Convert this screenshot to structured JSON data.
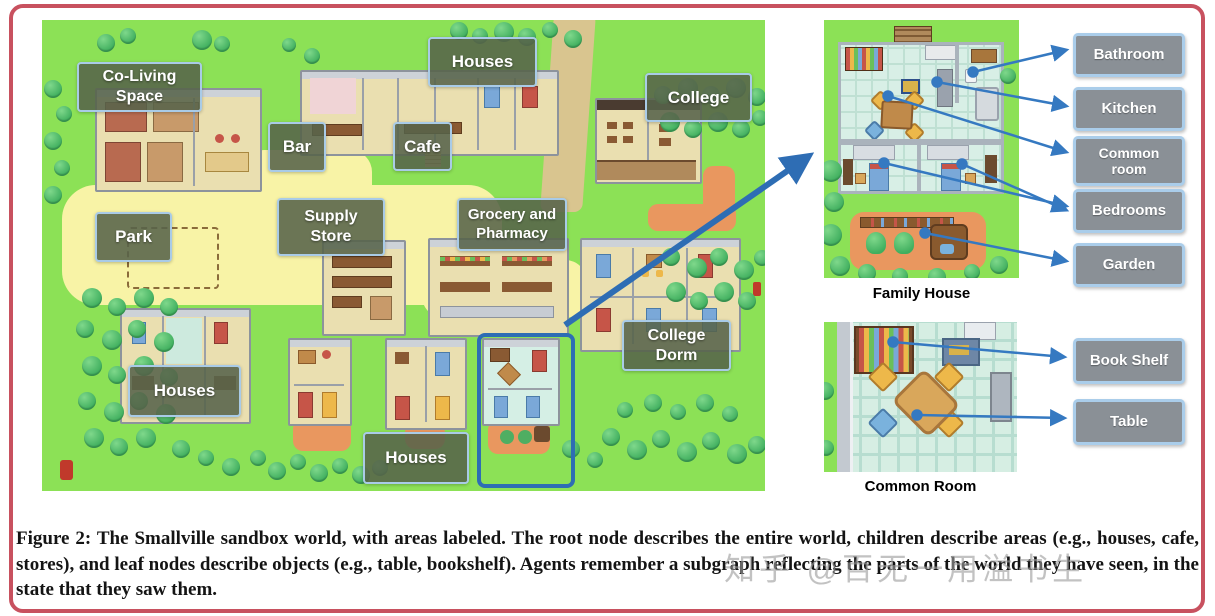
{
  "map": {
    "labels": {
      "co_living_space": "Co-Living\nSpace",
      "houses_top": "Houses",
      "bar": "Bar",
      "cafe": "Cafe",
      "college": "College",
      "supply_store": "Supply\nStore",
      "grocery_pharmacy": "Grocery and\nPharmacy",
      "park": "Park",
      "college_dorm": "College\nDorm",
      "houses_bottom_left": "Houses",
      "houses_bottom_middle": "Houses"
    }
  },
  "family_house": {
    "caption": "Family House",
    "labels": {
      "bathroom": "Bathroom",
      "kitchen": "Kitchen",
      "common_room": "Common\nroom",
      "bedrooms": "Bedrooms",
      "garden": "Garden"
    }
  },
  "common_room": {
    "caption": "Common Room",
    "labels": {
      "book_shelf": "Book Shelf",
      "table": "Table"
    }
  },
  "caption_text": "Figure 2: The Smallville sandbox world, with areas labeled. The root node describes the entire world, children describe areas (e.g., houses, cafe, stores), and leaf nodes describe objects (e.g., table, bookshelf). Agents remember a subgraph reflecting the parts of the world they have seen, in the state that they saw them.",
  "watermark": "知乎 @百无一用溢书生",
  "colors": {
    "frame": "#c8515f",
    "grass": "#8ce156",
    "path": "#f8f3a6",
    "arrow_blue": "#3579c1",
    "highlight_blue": "#2e6db4",
    "map_label_bg": "#56634a",
    "side_label_bg": "#8a9096",
    "label_border": "#a9cbe7"
  }
}
